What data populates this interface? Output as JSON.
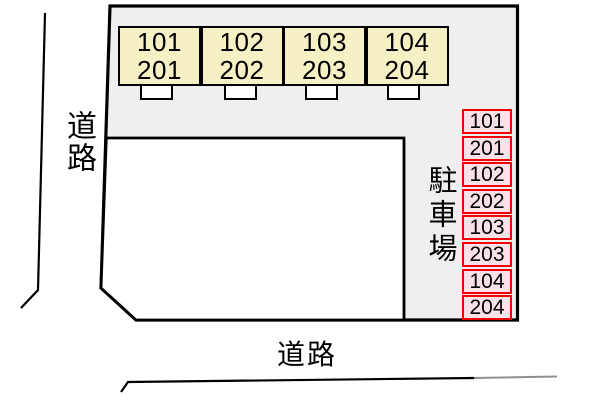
{
  "building": {
    "units": [
      {
        "floor1": "101",
        "floor2": "201"
      },
      {
        "floor1": "102",
        "floor2": "202"
      },
      {
        "floor1": "103",
        "floor2": "203"
      },
      {
        "floor1": "104",
        "floor2": "204"
      }
    ]
  },
  "parking": {
    "label": "駐車場",
    "spaces": [
      "101",
      "201",
      "102",
      "202",
      "103",
      "203",
      "104",
      "204"
    ]
  },
  "roads": {
    "left": "道路",
    "bottom": "道路"
  },
  "colors": {
    "site_fill": "#efefef",
    "building_fill": "#ffffff",
    "outline": "#000000",
    "unit_fill": "#f6f0c5",
    "parking_fill": "#f9e1e9",
    "parking_border": "#f40000",
    "faded_line": "#8f8f8f"
  }
}
